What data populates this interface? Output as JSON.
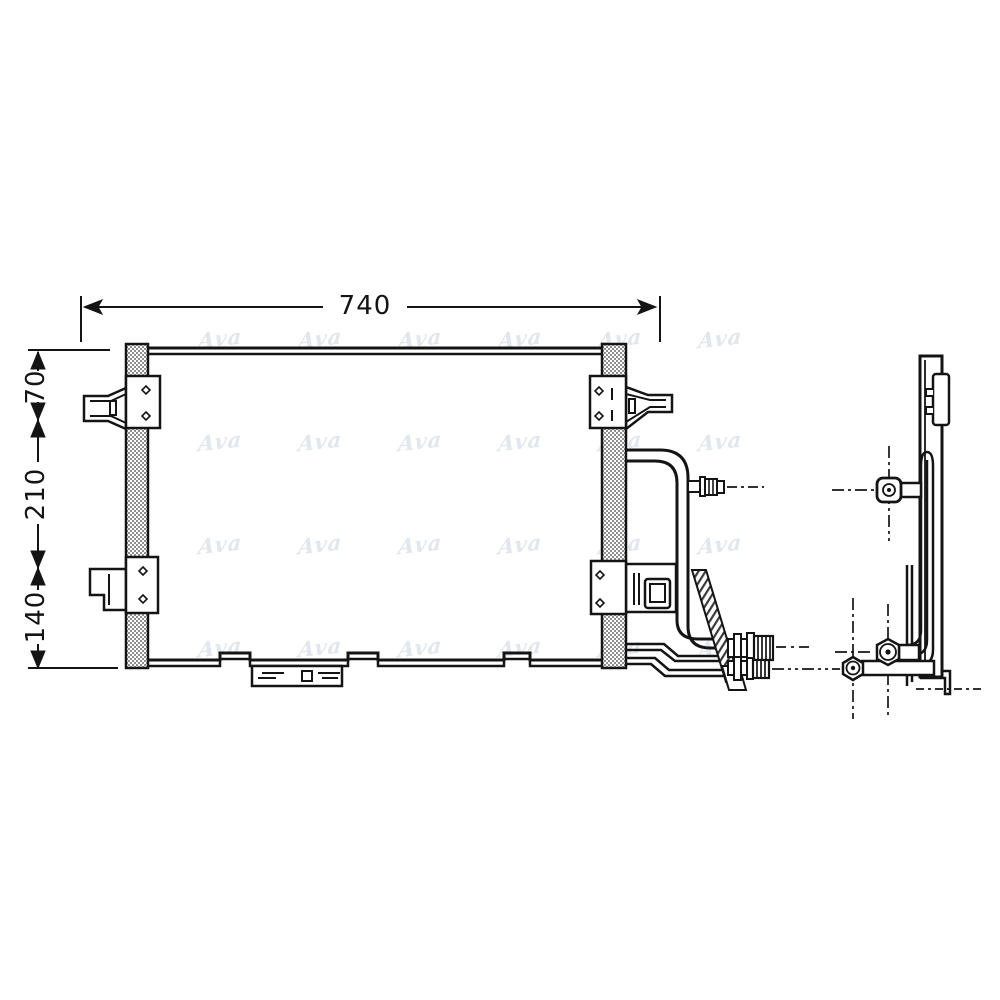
{
  "image": {
    "background": "#ffffff",
    "ink": "#141414",
    "tank_hatch_color": "#8e8e8e"
  },
  "dimensions": {
    "width_mm": "740",
    "left_segments": [
      "70",
      "210",
      "140"
    ]
  },
  "watermark": {
    "text": "Ava",
    "color": "#e2e6ed"
  }
}
